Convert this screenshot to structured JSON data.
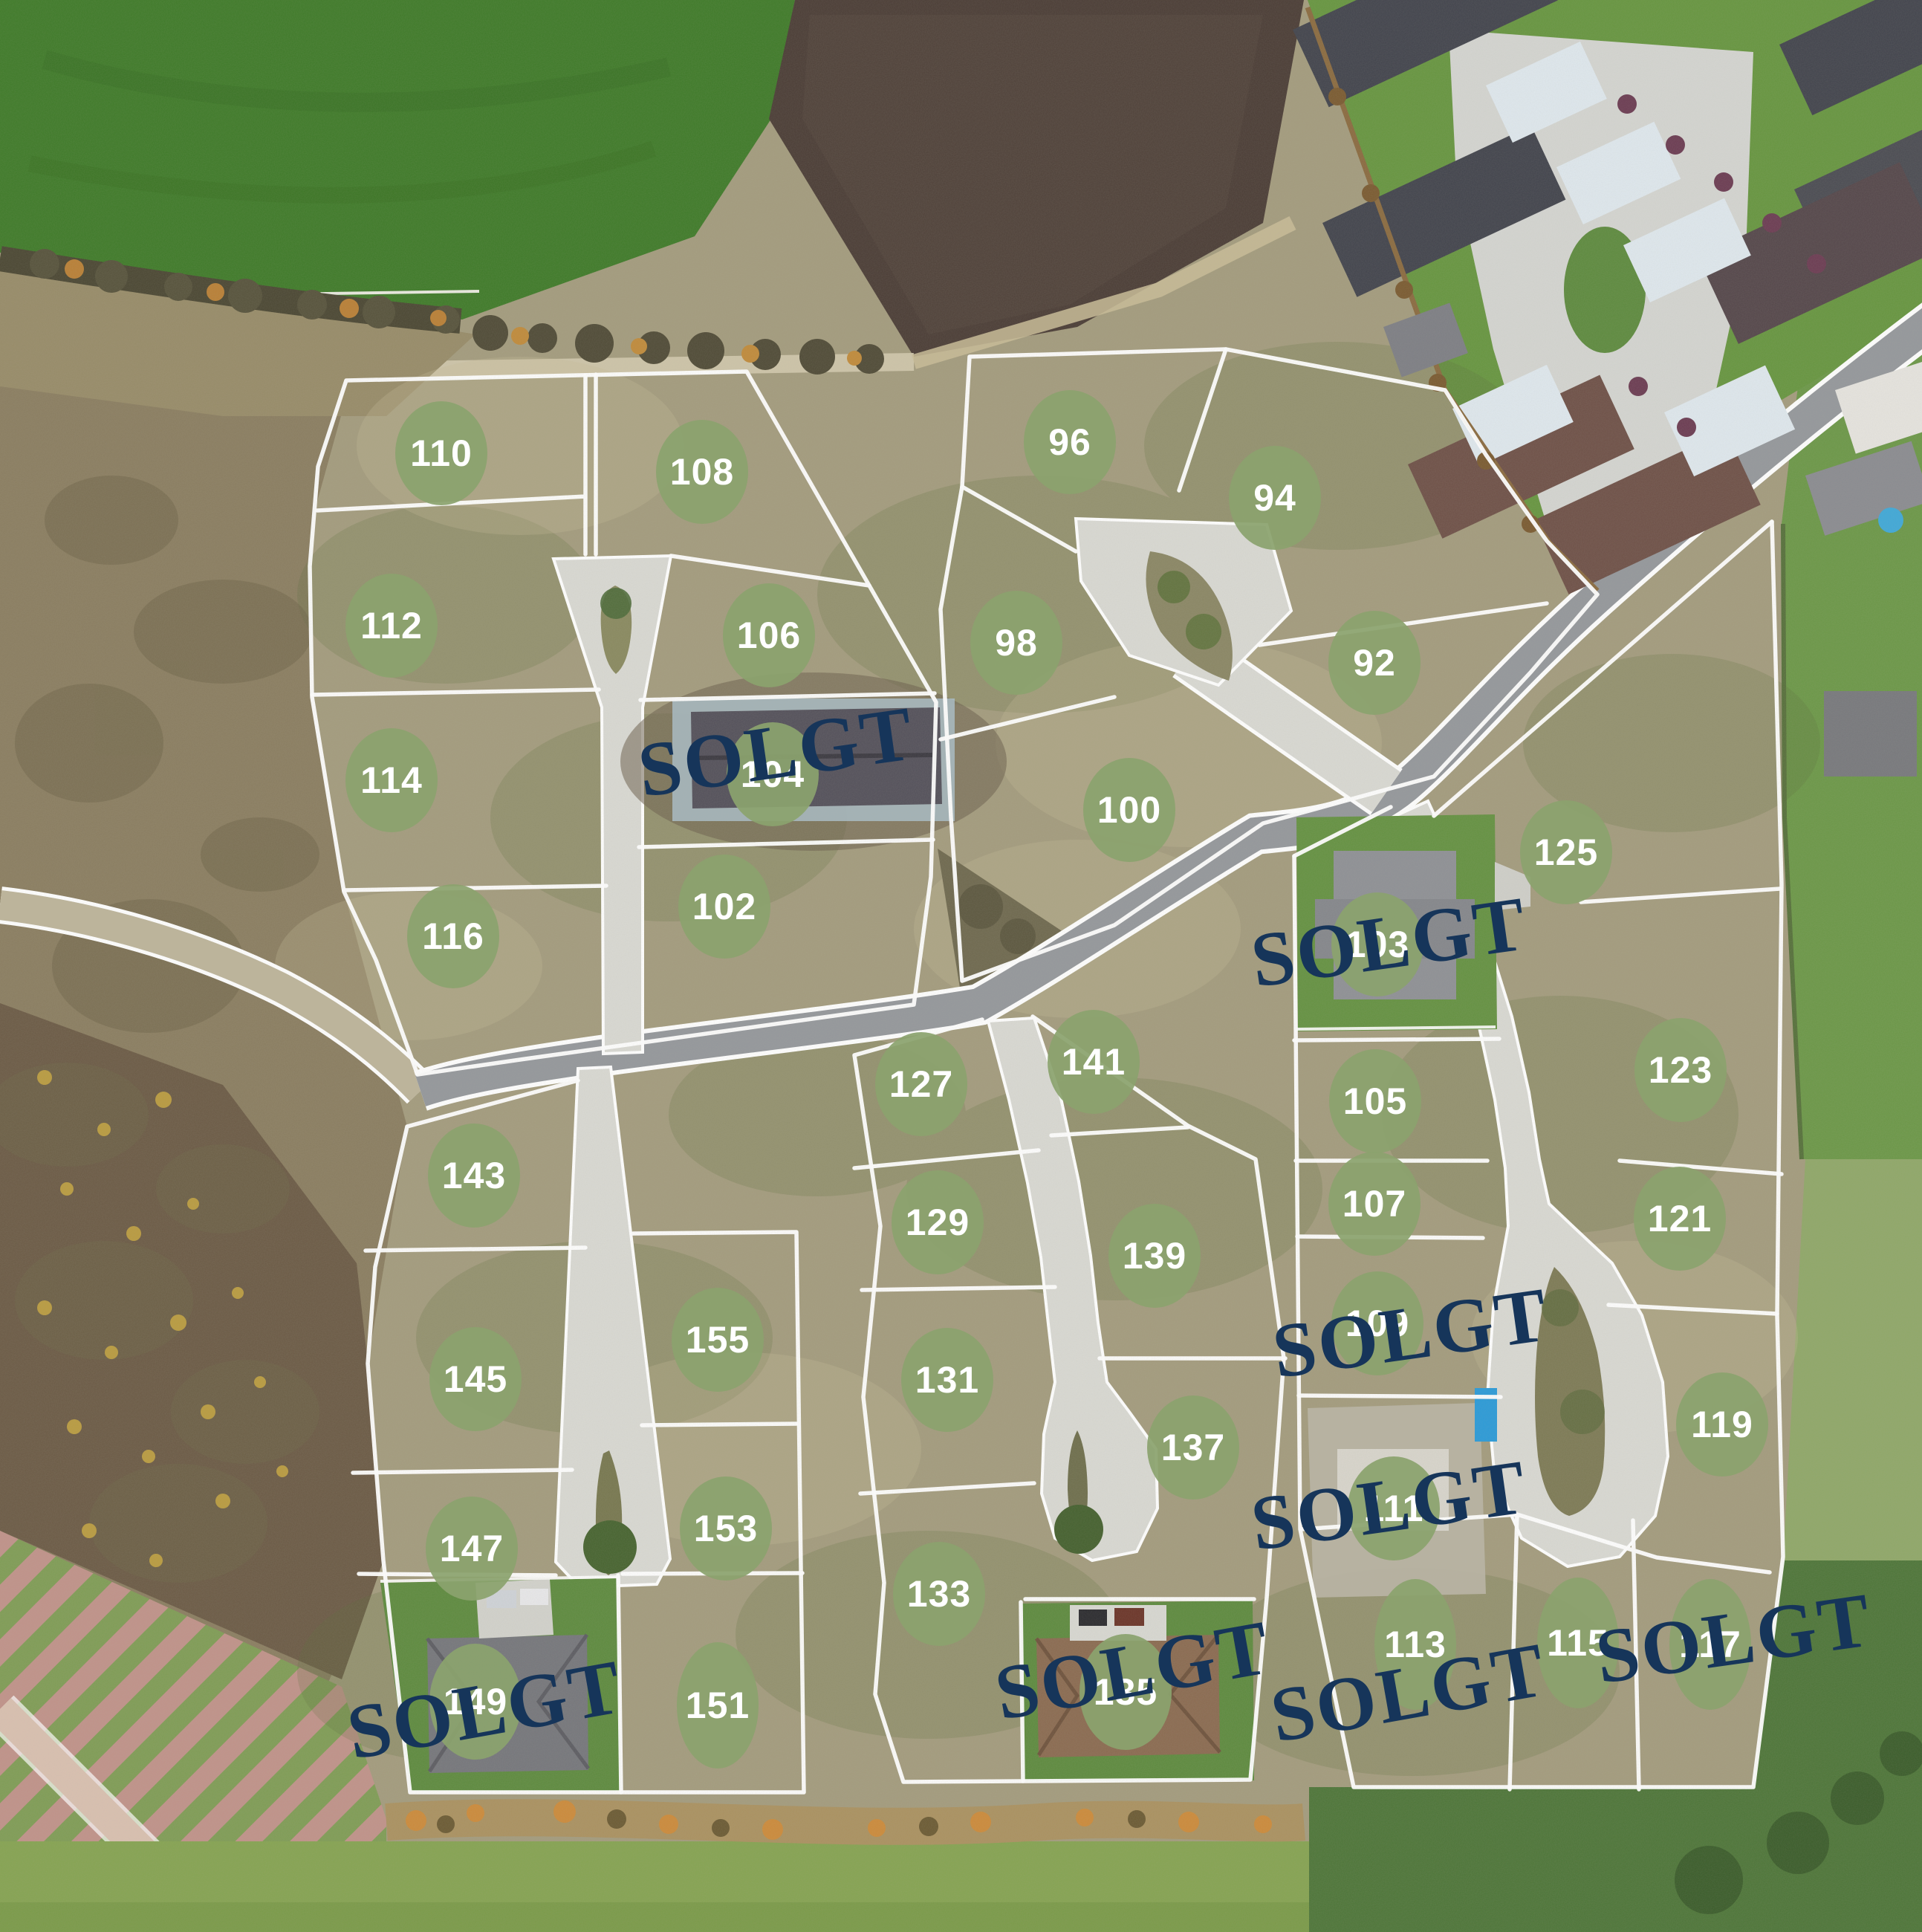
{
  "map": {
    "kind": "residential-lot-site-plan-aerial",
    "sold_label": "SOLGT"
  },
  "sold_label": "SOLGT",
  "colors": {
    "marker_fill": "#8BA36E",
    "marker_text": "#FFFFFF",
    "sold_text": "#16355A",
    "boundary_line": "#FFFFFF",
    "road_asphalt": "#94979B",
    "concrete": "#D9D9D3"
  },
  "plots": {
    "92": {
      "label": "92",
      "status": "available"
    },
    "94": {
      "label": "94",
      "status": "available"
    },
    "96": {
      "label": "96",
      "status": "available"
    },
    "98": {
      "label": "98",
      "status": "available"
    },
    "100": {
      "label": "100",
      "status": "available"
    },
    "102": {
      "label": "102",
      "status": "available"
    },
    "103": {
      "label": "103",
      "status": "sold"
    },
    "104": {
      "label": "104",
      "status": "sold"
    },
    "105": {
      "label": "105",
      "status": "available"
    },
    "106": {
      "label": "106",
      "status": "available"
    },
    "107": {
      "label": "107",
      "status": "available"
    },
    "108": {
      "label": "108",
      "status": "available"
    },
    "109": {
      "label": "109",
      "status": "sold"
    },
    "110": {
      "label": "110",
      "status": "available"
    },
    "111": {
      "label": "111",
      "status": "sold"
    },
    "112": {
      "label": "112",
      "status": "available"
    },
    "113": {
      "label": "113",
      "status": "sold"
    },
    "114": {
      "label": "114",
      "status": "available"
    },
    "115": {
      "label": "115",
      "status": "available"
    },
    "116": {
      "label": "116",
      "status": "available"
    },
    "117": {
      "label": "117",
      "status": "sold"
    },
    "119": {
      "label": "119",
      "status": "available"
    },
    "121": {
      "label": "121",
      "status": "available"
    },
    "123": {
      "label": "123",
      "status": "available"
    },
    "125": {
      "label": "125",
      "status": "available"
    },
    "127": {
      "label": "127",
      "status": "available"
    },
    "129": {
      "label": "129",
      "status": "available"
    },
    "131": {
      "label": "131",
      "status": "available"
    },
    "133": {
      "label": "133",
      "status": "available"
    },
    "135": {
      "label": "135",
      "status": "sold"
    },
    "137": {
      "label": "137",
      "status": "available"
    },
    "139": {
      "label": "139",
      "status": "available"
    },
    "141": {
      "label": "141",
      "status": "available"
    },
    "143": {
      "label": "143",
      "status": "available"
    },
    "145": {
      "label": "145",
      "status": "available"
    },
    "147": {
      "label": "147",
      "status": "available"
    },
    "149": {
      "label": "149",
      "status": "sold"
    },
    "151": {
      "label": "151",
      "status": "available"
    },
    "153": {
      "label": "153",
      "status": "available"
    },
    "155": {
      "label": "155",
      "status": "available"
    }
  }
}
